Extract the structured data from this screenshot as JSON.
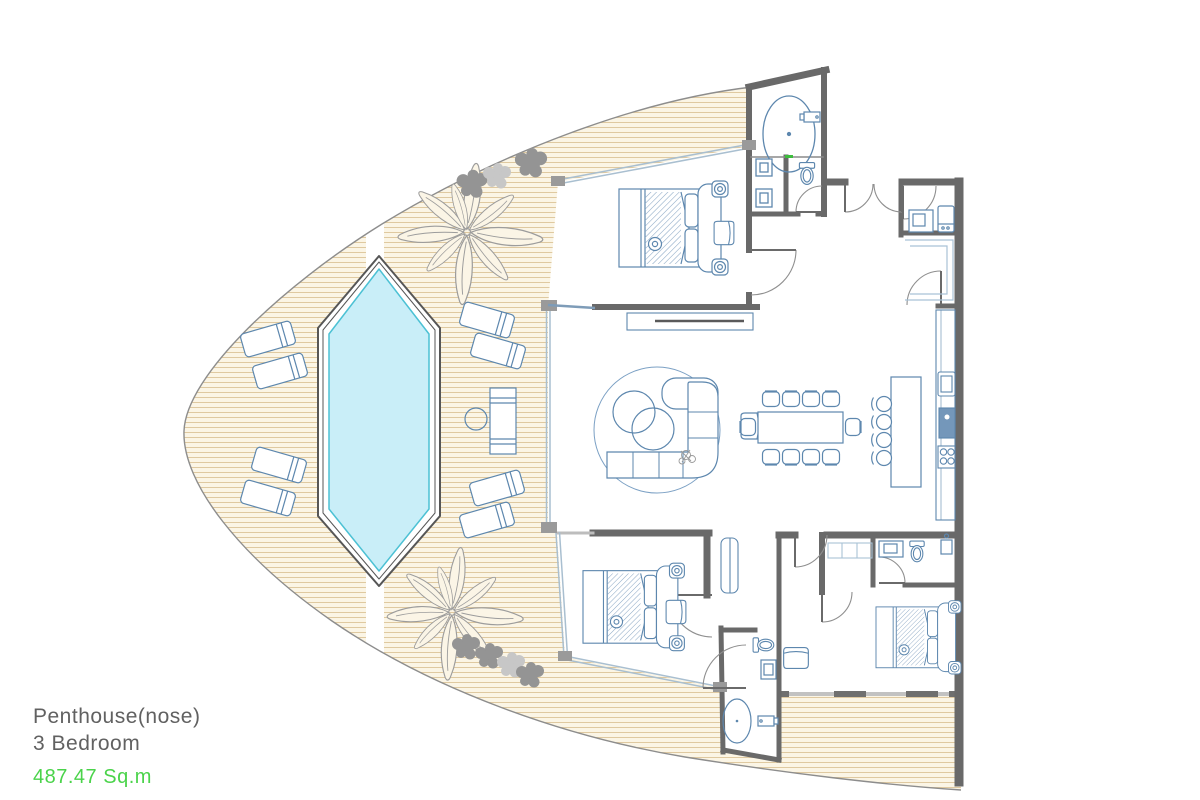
{
  "plan": {
    "title": "Penthouse(nose)",
    "subtitle": "3 Bedroom",
    "area": "487.47 Sq.m"
  },
  "colors": {
    "pool_water": "#c9eef8",
    "pool_edge": "#4cc1d4",
    "deck_base": "#fbf5e5",
    "deck_hatch": "#dfc9a0",
    "wall": "#696969",
    "window_line": "#bdbdbd",
    "furniture_line": "#5d87ae",
    "glass_line": "#a9bfd0",
    "foliage_dark": "#949494",
    "foliage_light": "#c7c7c7",
    "area_text": "#4ad34a",
    "label_text": "#616161"
  }
}
